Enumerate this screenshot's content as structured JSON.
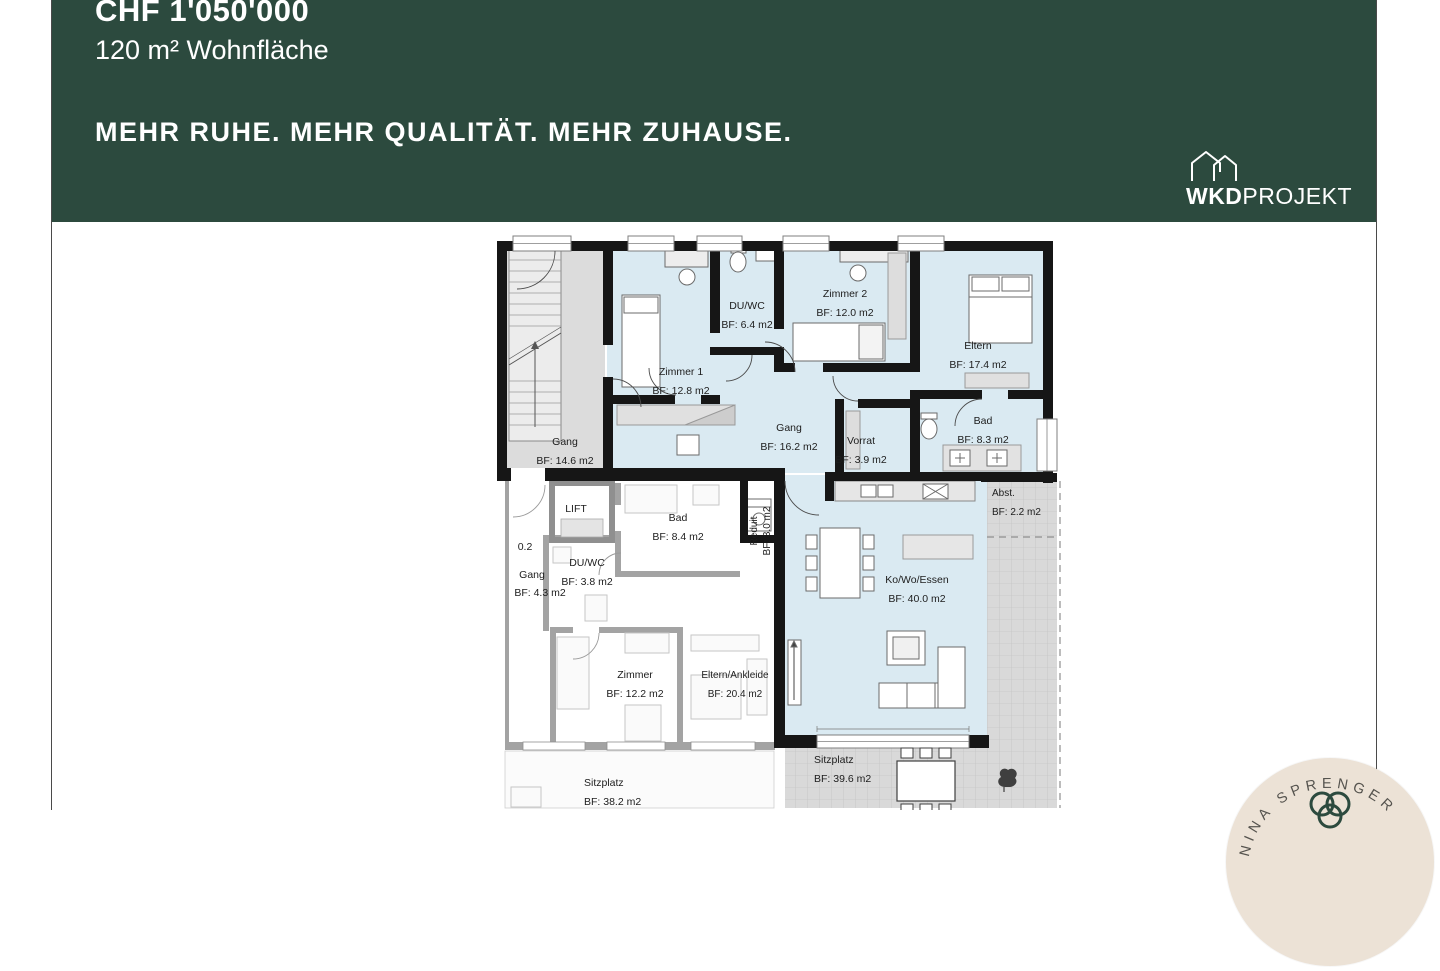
{
  "header": {
    "price": "CHF 1'050'000",
    "area": "120 m² Wohnfläche",
    "slogan": "MEHR RUHE. MEHR QUALITÄT. MEHR ZUHAUSE.",
    "background": "#2c4a3e",
    "text_color": "#ffffff",
    "brand": {
      "bold": "WKD",
      "light": "PROJEKT"
    }
  },
  "floorplan": {
    "unit_fill": "#daeaf2",
    "stair_fill": "#dcdcdc",
    "terrace_fill": "#d9d9d9",
    "wall_color": "#161616",
    "faded_wall_color": "#a3a3a3",
    "lift_label": "LIFT",
    "level_label": "0.2",
    "rooms": [
      {
        "name": "Gang",
        "area": "BF: 14.6 m2"
      },
      {
        "name": "Zimmer 1",
        "area": "BF: 12.8 m2"
      },
      {
        "name": "DU/WC",
        "area": "BF: 6.4 m2"
      },
      {
        "name": "Zimmer 2",
        "area": "BF: 12.0 m2"
      },
      {
        "name": "Eltern",
        "area": "BF: 17.4 m2"
      },
      {
        "name": "Bad",
        "area": "BF: 8.3 m2"
      },
      {
        "name": "Gang",
        "area": "BF: 16.2 m2"
      },
      {
        "name": "Vorrat",
        "area": "BF: 3.9 m2"
      },
      {
        "name": "Reduit",
        "area": "BF: 3.0 m2"
      },
      {
        "name": "Bad",
        "area": "BF: 8.4 m2"
      },
      {
        "name": "DU/WC",
        "area": "BF: 3.8 m2"
      },
      {
        "name": "Gang",
        "area": "BF: 4.3 m2"
      },
      {
        "name": "Zimmer",
        "area": "BF: 12.2 m2"
      },
      {
        "name": "Eltern/Ankleide",
        "area": "BF: 20.4 m2"
      },
      {
        "name": "Ko/Wo/Essen",
        "area": "BF: 40.0 m2"
      },
      {
        "name": "Abst.",
        "area": "BF: 2.2 m2"
      },
      {
        "name": "Sitzplatz",
        "area": "BF: 39.6 m2"
      },
      {
        "name": "Sitzplatz",
        "area": "BF: 38.2 m2"
      }
    ]
  },
  "badge": {
    "name": "NINA SPRENGER",
    "background": "#ece2d6",
    "accent": "#2c4a3e",
    "text_color": "#55534e"
  }
}
